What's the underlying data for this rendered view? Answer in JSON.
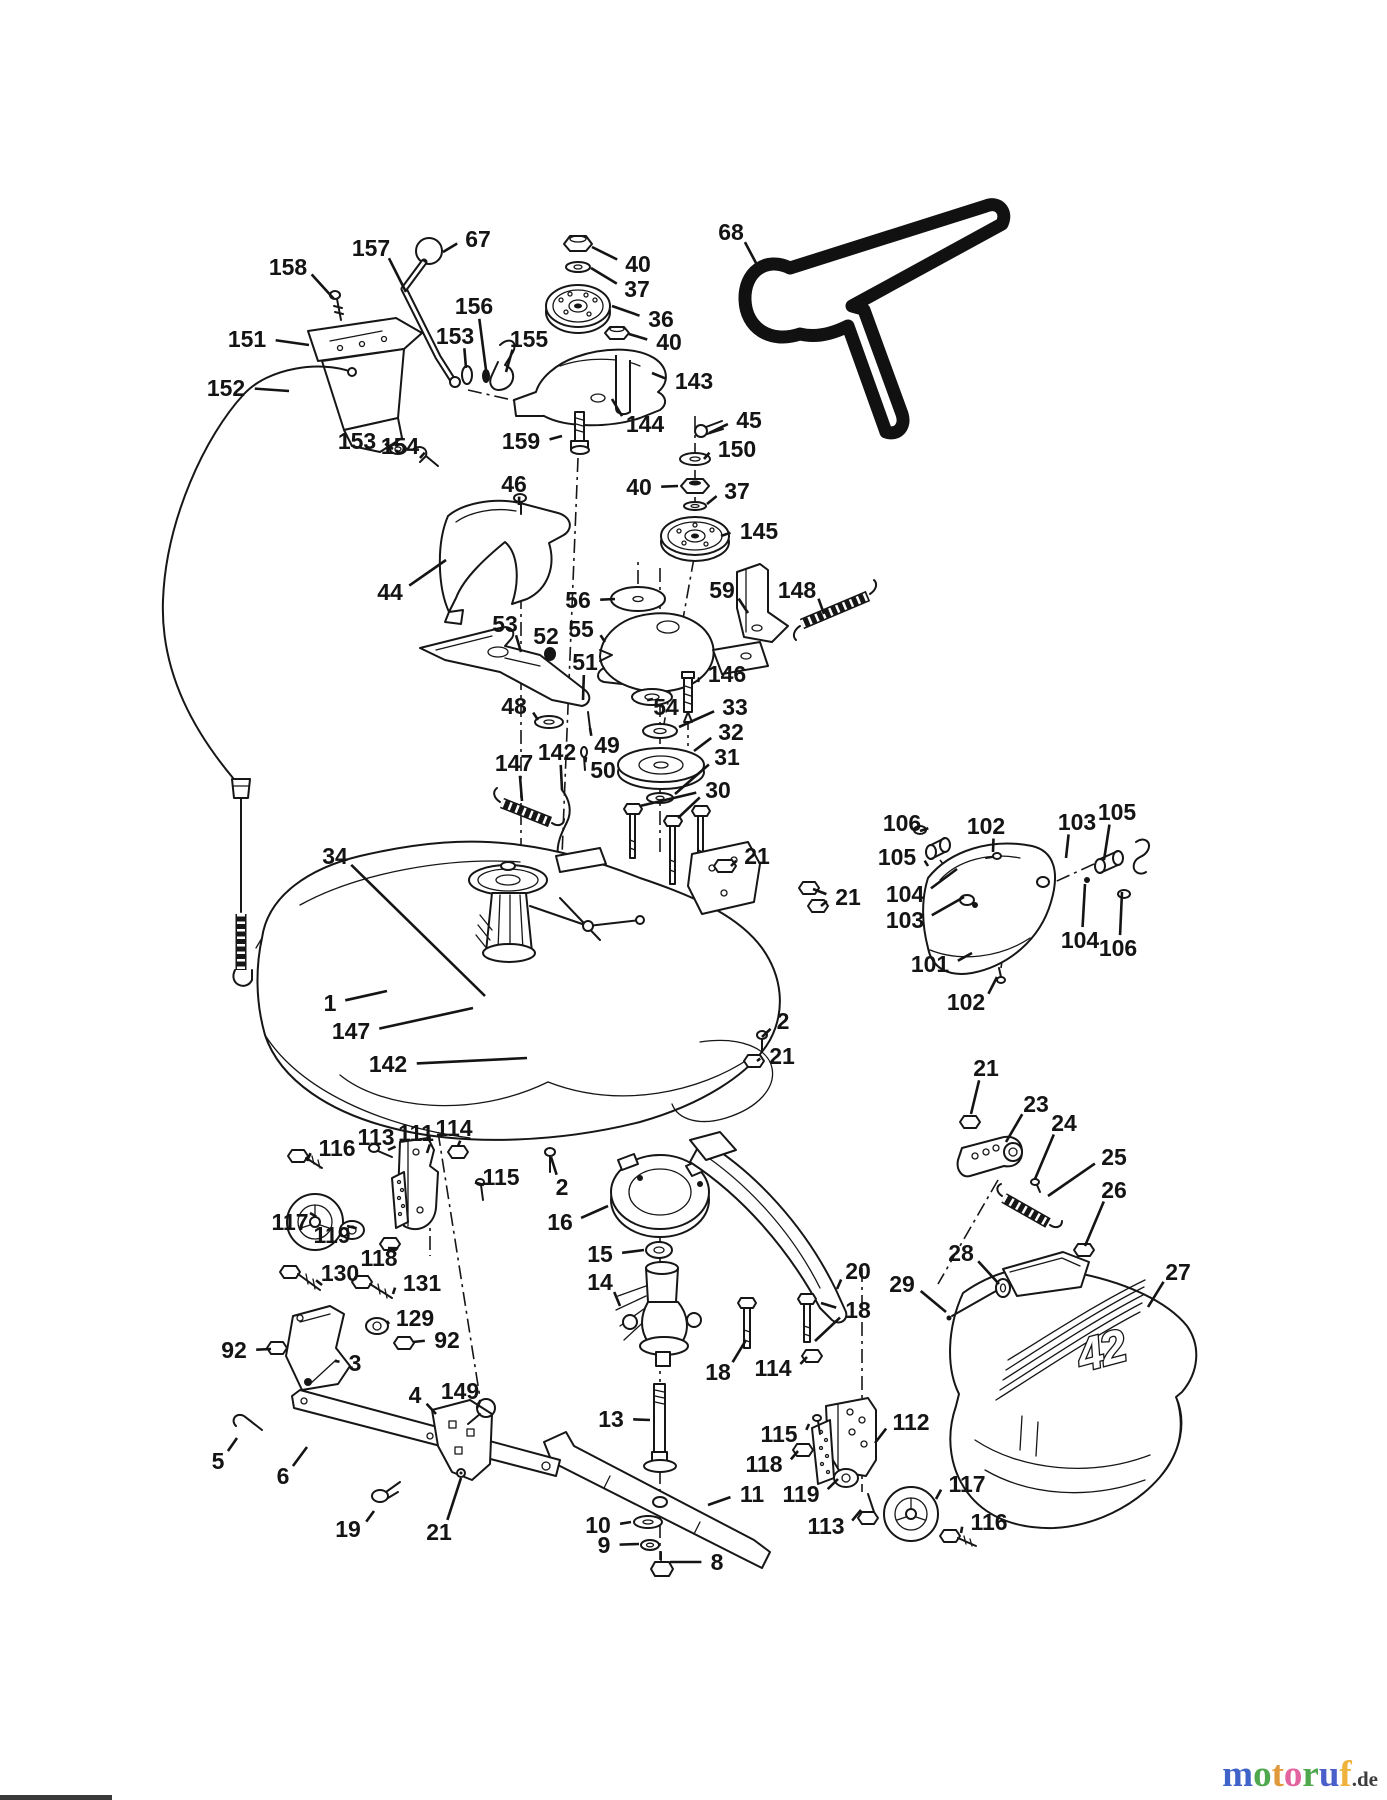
{
  "watermark": {
    "word": "motoruf",
    "suffix": ".de",
    "suffix_color": "#3c3c3c",
    "letters": [
      {
        "ch": "m",
        "color": "#3f63c9"
      },
      {
        "ch": "o",
        "color": "#4fa84d"
      },
      {
        "ch": "t",
        "color": "#e09a3c"
      },
      {
        "ch": "o",
        "color": "#e2639f"
      },
      {
        "ch": "r",
        "color": "#4fa84d"
      },
      {
        "ch": "u",
        "color": "#4a5fc9"
      },
      {
        "ch": "f",
        "color": "#efb23b"
      }
    ]
  },
  "diagram": {
    "deck_size_label": "42",
    "ink": "#161616",
    "labels": [
      {
        "n": "67",
        "x": 478,
        "y": 239,
        "tx": 443,
        "ty": 252
      },
      {
        "n": "157",
        "x": 371,
        "y": 248,
        "tx": 406,
        "ty": 292
      },
      {
        "n": "158",
        "x": 288,
        "y": 267,
        "tx": 334,
        "ty": 299
      },
      {
        "n": "151",
        "x": 247,
        "y": 339,
        "tx": 309,
        "ty": 345
      },
      {
        "n": "152",
        "x": 226,
        "y": 388,
        "tx": 289,
        "ty": 391
      },
      {
        "n": "153",
        "x": 455,
        "y": 336,
        "tx": 466,
        "ty": 368
      },
      {
        "n": "156",
        "x": 474,
        "y": 306,
        "tx": 486,
        "ty": 370
      },
      {
        "n": "155",
        "x": 529,
        "y": 339,
        "tx": 506,
        "ty": 372
      },
      {
        "n": "153",
        "x": 357,
        "y": 441,
        "tx": 393,
        "ty": 449
      },
      {
        "n": "154",
        "x": 400,
        "y": 446,
        "tx": 420,
        "ty": 458
      },
      {
        "n": "40",
        "x": 638,
        "y": 264,
        "tx": 592,
        "ty": 247
      },
      {
        "n": "37",
        "x": 637,
        "y": 289,
        "tx": 591,
        "ty": 268
      },
      {
        "n": "36",
        "x": 661,
        "y": 319,
        "tx": 612,
        "ty": 306
      },
      {
        "n": "40",
        "x": 669,
        "y": 342,
        "tx": 629,
        "ty": 334
      },
      {
        "n": "143",
        "x": 694,
        "y": 381,
        "tx": 652,
        "ty": 373
      },
      {
        "n": "144",
        "x": 645,
        "y": 424,
        "tx": 612,
        "ty": 399
      },
      {
        "n": "159",
        "x": 521,
        "y": 441,
        "tx": 562,
        "ty": 436
      },
      {
        "n": "68",
        "x": 731,
        "y": 232,
        "tx": 756,
        "ty": 263
      },
      {
        "n": "45",
        "x": 749,
        "y": 420,
        "tx": 709,
        "ty": 433
      },
      {
        "n": "150",
        "x": 737,
        "y": 449,
        "tx": 704,
        "ty": 459
      },
      {
        "n": "40",
        "x": 639,
        "y": 487,
        "tx": 678,
        "ty": 486
      },
      {
        "n": "37",
        "x": 737,
        "y": 491,
        "tx": 707,
        "ty": 504
      },
      {
        "n": "145",
        "x": 759,
        "y": 531,
        "tx": 721,
        "ty": 536
      },
      {
        "n": "46",
        "x": 514,
        "y": 484,
        "tx": 519,
        "ty": 505
      },
      {
        "n": "44",
        "x": 390,
        "y": 592,
        "tx": 446,
        "ty": 560
      },
      {
        "n": "56",
        "x": 578,
        "y": 600,
        "tx": 615,
        "ty": 599
      },
      {
        "n": "59",
        "x": 722,
        "y": 590,
        "tx": 748,
        "ty": 613
      },
      {
        "n": "148",
        "x": 797,
        "y": 590,
        "tx": 824,
        "ty": 614
      },
      {
        "n": "55",
        "x": 581,
        "y": 629,
        "tx": 605,
        "ty": 642
      },
      {
        "n": "146",
        "x": 727,
        "y": 674,
        "tx": 698,
        "ty": 682
      },
      {
        "n": "53",
        "x": 505,
        "y": 624,
        "tx": 521,
        "ty": 652
      },
      {
        "n": "52",
        "x": 546,
        "y": 636,
        "tx": 550,
        "ty": 652
      },
      {
        "n": "51",
        "x": 585,
        "y": 662,
        "tx": 583,
        "ty": 700
      },
      {
        "n": "48",
        "x": 514,
        "y": 706,
        "tx": 538,
        "ty": 720
      },
      {
        "n": "49",
        "x": 607,
        "y": 745,
        "tx": 590,
        "ty": 728
      },
      {
        "n": "50",
        "x": 603,
        "y": 770,
        "tx": 586,
        "ty": 757
      },
      {
        "n": "54",
        "x": 666,
        "y": 707,
        "tx": 653,
        "ty": 699
      },
      {
        "n": "33",
        "x": 735,
        "y": 707,
        "tx": 679,
        "ty": 727
      },
      {
        "n": "32",
        "x": 731,
        "y": 732,
        "tx": 694,
        "ty": 751
      },
      {
        "n": "31",
        "x": 727,
        "y": 757,
        "tx": 675,
        "ty": 794
      },
      {
        "n": "30",
        "x": 718,
        "y": 790,
        "tx": 640,
        "ty": 806,
        "tx2": 678,
        "ty2": 818
      },
      {
        "n": "21",
        "x": 757,
        "y": 856,
        "tx": 731,
        "ty": 866
      },
      {
        "n": "21",
        "x": 848,
        "y": 897,
        "tx": 813,
        "ty": 889,
        "tx2": 821,
        "ty2": 906
      },
      {
        "n": "147",
        "x": 514,
        "y": 763,
        "tx": 522,
        "ty": 801
      },
      {
        "n": "142",
        "x": 557,
        "y": 752,
        "tx": 562,
        "ty": 790
      },
      {
        "n": "34",
        "x": 335,
        "y": 856,
        "tx": 485,
        "ty": 996
      },
      {
        "n": "1",
        "x": 330,
        "y": 1003,
        "tx": 387,
        "ty": 991
      },
      {
        "n": "147",
        "x": 351,
        "y": 1031,
        "tx": 473,
        "ty": 1008
      },
      {
        "n": "142",
        "x": 388,
        "y": 1064,
        "tx": 527,
        "ty": 1058
      },
      {
        "n": "2",
        "x": 783,
        "y": 1021,
        "tx": 762,
        "ty": 1037
      },
      {
        "n": "21",
        "x": 782,
        "y": 1056,
        "tx": 757,
        "ty": 1061
      },
      {
        "n": "2",
        "x": 562,
        "y": 1187,
        "tx": 551,
        "ty": 1157
      },
      {
        "n": "106",
        "x": 902,
        "y": 823,
        "tx": 920,
        "ty": 831
      },
      {
        "n": "102",
        "x": 986,
        "y": 826,
        "tx": 993,
        "ty": 852
      },
      {
        "n": "103",
        "x": 1077,
        "y": 822,
        "tx": 1066,
        "ty": 858
      },
      {
        "n": "105",
        "x": 1117,
        "y": 812,
        "tx": 1104,
        "ty": 860
      },
      {
        "n": "105",
        "x": 897,
        "y": 857,
        "tx": 928,
        "ty": 866
      },
      {
        "n": "104",
        "x": 905,
        "y": 894,
        "tx": 957,
        "ty": 869
      },
      {
        "n": "103",
        "x": 905,
        "y": 920,
        "tx": 964,
        "ty": 897
      },
      {
        "n": "101",
        "x": 930,
        "y": 964,
        "tx": 972,
        "ty": 953
      },
      {
        "n": "104",
        "x": 1080,
        "y": 940,
        "tx": 1085,
        "ty": 884
      },
      {
        "n": "106",
        "x": 1118,
        "y": 948,
        "tx": 1122,
        "ty": 892
      },
      {
        "n": "102",
        "x": 966,
        "y": 1002,
        "tx": 997,
        "ty": 977
      },
      {
        "n": "21",
        "x": 986,
        "y": 1068,
        "tx": 971,
        "ty": 1114
      },
      {
        "n": "23",
        "x": 1036,
        "y": 1104,
        "tx": 1006,
        "ty": 1142
      },
      {
        "n": "24",
        "x": 1064,
        "y": 1123,
        "tx": 1035,
        "ty": 1179
      },
      {
        "n": "25",
        "x": 1114,
        "y": 1157,
        "tx": 1048,
        "ty": 1196
      },
      {
        "n": "26",
        "x": 1114,
        "y": 1190,
        "tx": 1085,
        "ty": 1246
      },
      {
        "n": "28",
        "x": 961,
        "y": 1253,
        "tx": 999,
        "ty": 1284
      },
      {
        "n": "29",
        "x": 902,
        "y": 1284,
        "tx": 946,
        "ty": 1312
      },
      {
        "n": "27",
        "x": 1178,
        "y": 1272,
        "tx": 1148,
        "ty": 1307
      },
      {
        "n": "20",
        "x": 858,
        "y": 1271,
        "tx": 837,
        "ty": 1289
      },
      {
        "n": "18",
        "x": 858,
        "y": 1310,
        "tx": 821,
        "ty": 1303,
        "tx2": 815,
        "ty2": 1341
      },
      {
        "n": "114",
        "x": 773,
        "y": 1368,
        "tx": 807,
        "ty": 1357
      },
      {
        "n": "18",
        "x": 718,
        "y": 1372,
        "tx": 746,
        "ty": 1340
      },
      {
        "n": "112",
        "x": 911,
        "y": 1422,
        "tx": 875,
        "ty": 1443
      },
      {
        "n": "115",
        "x": 779,
        "y": 1434,
        "tx": 809,
        "ty": 1424
      },
      {
        "n": "118",
        "x": 764,
        "y": 1464,
        "tx": 798,
        "ty": 1451
      },
      {
        "n": "119",
        "x": 801,
        "y": 1494,
        "tx": 838,
        "ty": 1479
      },
      {
        "n": "113",
        "x": 826,
        "y": 1526,
        "tx": 861,
        "ty": 1510
      },
      {
        "n": "117",
        "x": 967,
        "y": 1484,
        "tx": 936,
        "ty": 1499
      },
      {
        "n": "116",
        "x": 989,
        "y": 1522,
        "tx": 961,
        "ty": 1533
      },
      {
        "n": "16",
        "x": 560,
        "y": 1222,
        "tx": 608,
        "ty": 1206
      },
      {
        "n": "15",
        "x": 600,
        "y": 1254,
        "tx": 644,
        "ty": 1250
      },
      {
        "n": "14",
        "x": 600,
        "y": 1282,
        "tx": 620,
        "ty": 1306
      },
      {
        "n": "13",
        "x": 611,
        "y": 1419,
        "tx": 650,
        "ty": 1420
      },
      {
        "n": "11",
        "x": 752,
        "y": 1494,
        "tx": 708,
        "ty": 1505
      },
      {
        "n": "10",
        "x": 598,
        "y": 1525,
        "tx": 631,
        "ty": 1522
      },
      {
        "n": "9",
        "x": 604,
        "y": 1545,
        "tx": 639,
        "ty": 1544
      },
      {
        "n": "8",
        "x": 717,
        "y": 1562,
        "tx": 670,
        "ty": 1562
      },
      {
        "n": "114",
        "x": 454,
        "y": 1128,
        "tx": 458,
        "ty": 1146
      },
      {
        "n": "111",
        "x": 416,
        "y": 1133,
        "tx": 427,
        "ty": 1153
      },
      {
        "n": "113",
        "x": 376,
        "y": 1137,
        "tx": 388,
        "ty": 1150
      },
      {
        "n": "116",
        "x": 337,
        "y": 1148,
        "tx": 307,
        "ty": 1161
      },
      {
        "n": "115",
        "x": 501,
        "y": 1177,
        "tx": 484,
        "ty": 1185
      },
      {
        "n": "117",
        "x": 290,
        "y": 1222,
        "tx": 310,
        "ty": 1213
      },
      {
        "n": "119",
        "x": 332,
        "y": 1235,
        "tx": 347,
        "ty": 1226
      },
      {
        "n": "118",
        "x": 379,
        "y": 1258,
        "tx": 388,
        "ty": 1248
      },
      {
        "n": "130",
        "x": 340,
        "y": 1273,
        "tx": 322,
        "ty": 1285
      },
      {
        "n": "131",
        "x": 422,
        "y": 1283,
        "tx": 393,
        "ty": 1294
      },
      {
        "n": "129",
        "x": 415,
        "y": 1318,
        "tx": 389,
        "ty": 1324
      },
      {
        "n": "92",
        "x": 234,
        "y": 1350,
        "tx": 271,
        "ty": 1349
      },
      {
        "n": "92",
        "x": 447,
        "y": 1340,
        "tx": 413,
        "ty": 1342
      },
      {
        "n": "3",
        "x": 355,
        "y": 1363,
        "tx": 335,
        "ty": 1361
      },
      {
        "n": "4",
        "x": 415,
        "y": 1395,
        "tx": 436,
        "ty": 1414
      },
      {
        "n": "149",
        "x": 460,
        "y": 1391,
        "tx": 477,
        "ty": 1408
      },
      {
        "n": "5",
        "x": 218,
        "y": 1461,
        "tx": 237,
        "ty": 1438
      },
      {
        "n": "6",
        "x": 283,
        "y": 1476,
        "tx": 307,
        "ty": 1447
      },
      {
        "n": "19",
        "x": 348,
        "y": 1529,
        "tx": 374,
        "ty": 1511
      },
      {
        "n": "21",
        "x": 439,
        "y": 1532,
        "tx": 461,
        "ty": 1478
      }
    ]
  }
}
